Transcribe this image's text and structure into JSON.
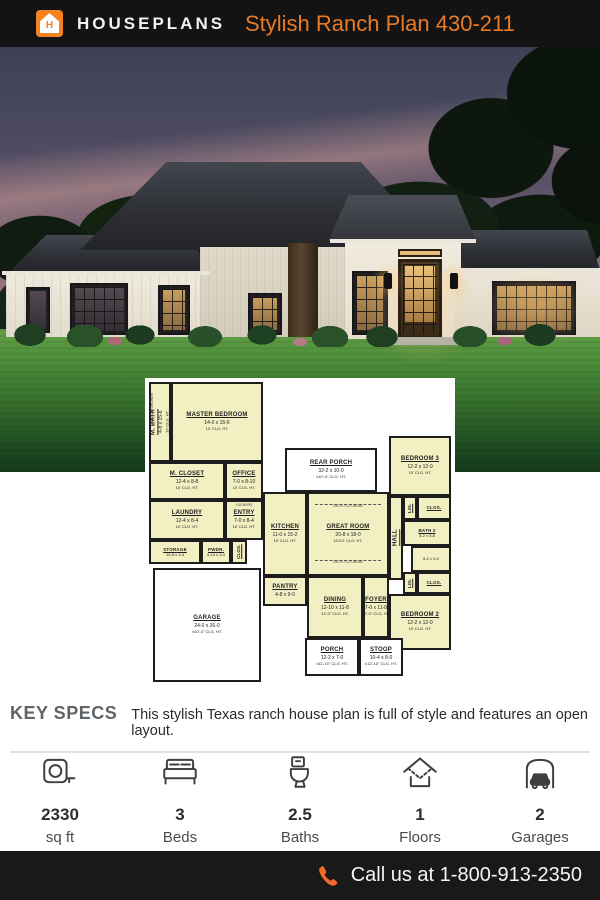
{
  "header": {
    "brand": "HOUSEPLANS",
    "logo_letter": "H",
    "title": "Stylish Ranch Plan 430-211"
  },
  "colors": {
    "accent_orange": "#f58220",
    "title_orange": "#e87b28",
    "header_bg": "#131313",
    "footer_bg": "#191919",
    "plan_room_fill": "#f2efc2"
  },
  "plan": {
    "rooms": {
      "mbath": {
        "name": "M. BATH",
        "dims": "4-8 x 15-6",
        "clg": "10' CLG. HT."
      },
      "master": {
        "name": "MASTER BEDROOM",
        "dims": "14-0 x 15-6",
        "clg": "10' CLG. HT."
      },
      "mcloset": {
        "name": "M. CLOSET",
        "dims": "12-4 x 8-8",
        "clg": "10' CLG. HT."
      },
      "office": {
        "name": "OFFICE",
        "dims": "7-0 x 8-10",
        "clg": "10' CLG. HT."
      },
      "laundry": {
        "name": "LAUNDRY",
        "dims": "12-4 x 8-4",
        "clg": "10' CLG. HT."
      },
      "entry": {
        "name": "ENTRY",
        "dims": "7-0 x 8-4",
        "clg": "10' CLG. HT."
      },
      "storage": {
        "name": "STORAGE",
        "dims": "10-8 x 3-4"
      },
      "pwdr": {
        "name": "PWDR.",
        "dims": "5-10 x 3-4"
      },
      "garage": {
        "name": "GARAGE",
        "dims": "24-0 x 26-0",
        "clg": "±10'-4\" CLG. HT."
      },
      "rearporch": {
        "name": "REAR PORCH",
        "dims": "32-2 x 10-0",
        "clg": "±10'-4\" CLG. HT."
      },
      "kitchen": {
        "name": "KITCHEN",
        "dims": "11-0 x 15-2",
        "clg": "10' CLG. HT."
      },
      "pantry": {
        "name": "PANTRY",
        "dims": "4-8 x 9-0"
      },
      "greatroom": {
        "name": "GREAT ROOM",
        "dims": "20-8 x 18-0",
        "clg": "10'/12' CLG. HT."
      },
      "dining": {
        "name": "DINING",
        "dims": "12-10 x 11-8",
        "clg": "12'-0\" CLG. HT."
      },
      "foyer": {
        "name": "FOYER",
        "dims": "7-0 x 11-8",
        "clg": "12'-0\" CLG. HT."
      },
      "bedroom3": {
        "name": "BEDROOM 3",
        "dims": "12-2 x 12-0",
        "clg": "10' CLG. HT."
      },
      "bath2": {
        "name": "BATH 2",
        "dims": "8-2 x 5-8"
      },
      "bath2b": {
        "dims": "8-2 x 5-0"
      },
      "bedroom2": {
        "name": "BEDROOM 2",
        "dims": "12-2 x 12-0",
        "clg": "10' CLG. HT."
      },
      "porch": {
        "name": "PORCH",
        "dims": "12-2 x 7-0",
        "clg": "±11'-10\" CLG. HT."
      },
      "stoop": {
        "name": "STOOP",
        "dims": "10-4 x 8-0",
        "clg": "±12'-10\" CLG. HT."
      },
      "hall": {
        "name": "HALL"
      },
      "clos": {
        "name": "CLOS."
      },
      "lin": {
        "name": "LIN."
      }
    },
    "labels": {
      "deco_beam": "DECO CLG BEAM",
      "lockers": "LOCKERS",
      "walk_in_shower": "WALK-IN SHOWER"
    }
  },
  "key_specs": {
    "label": "KEY SPECS",
    "description": "This stylish Texas ranch house plan is full of style and features an open layout."
  },
  "specs": [
    {
      "icon": "tape-measure-icon",
      "value": "2330",
      "label": "sq ft"
    },
    {
      "icon": "bed-icon",
      "value": "3",
      "label": "Beds"
    },
    {
      "icon": "toilet-icon",
      "value": "2.5",
      "label": "Baths"
    },
    {
      "icon": "house-floors-icon",
      "value": "1",
      "label": "Floors"
    },
    {
      "icon": "garage-car-icon",
      "value": "2",
      "label": "Garages"
    }
  ],
  "footer": {
    "call_text": "Call us at 1-800-913-2350"
  }
}
